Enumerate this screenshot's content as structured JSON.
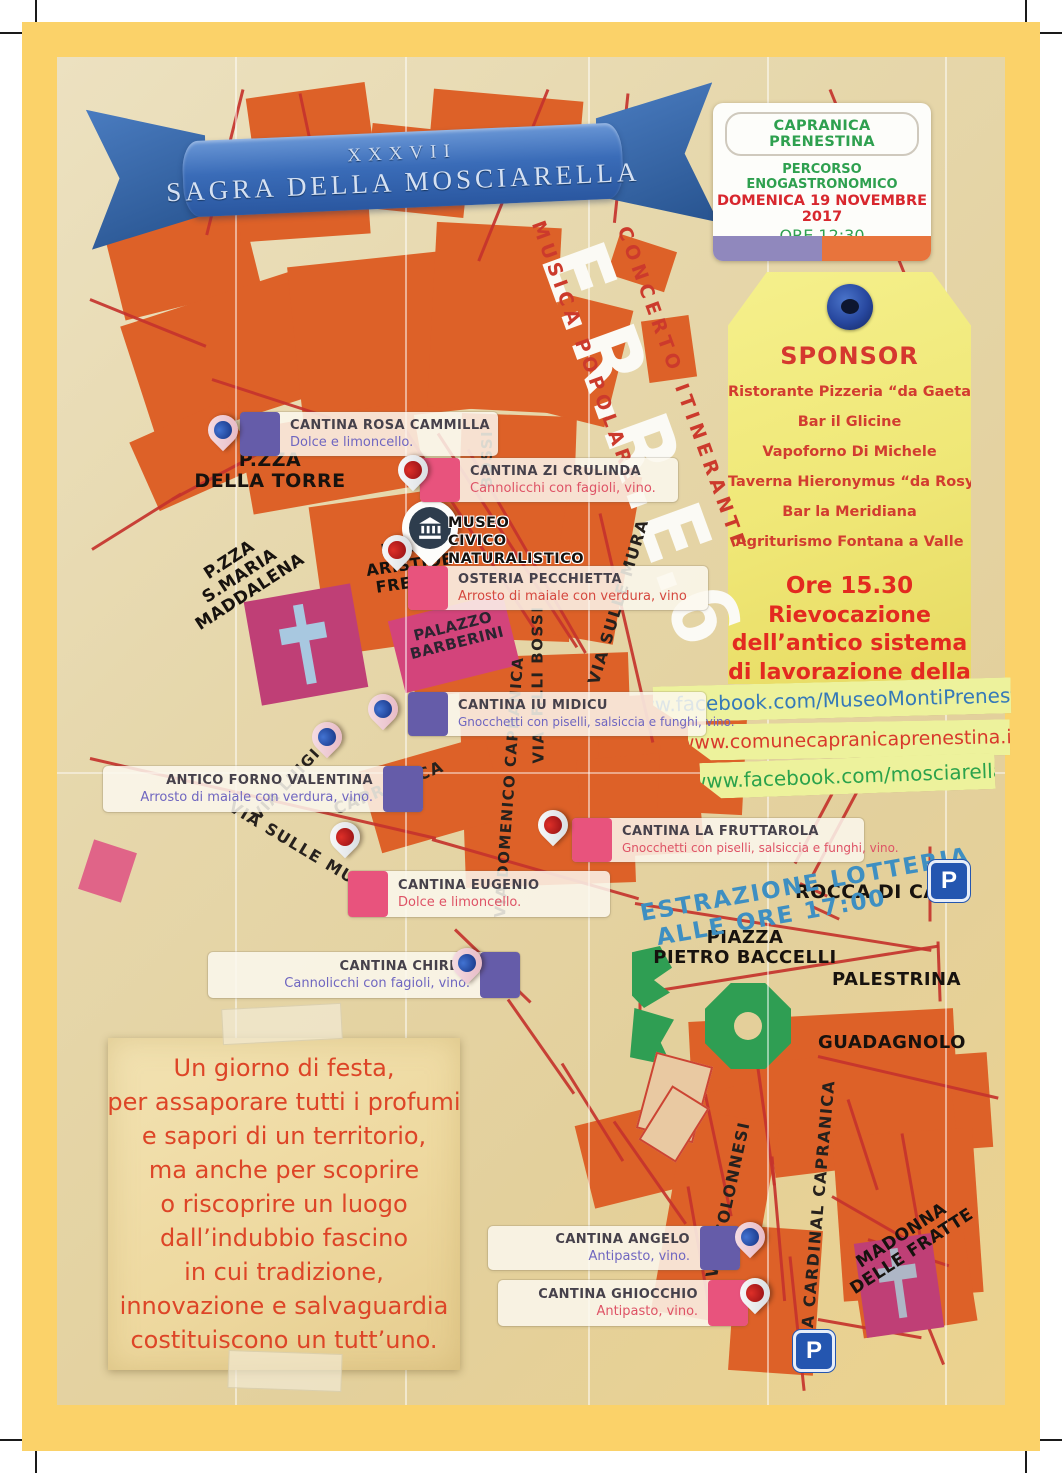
{
  "banner": {
    "edition": "XXXVII",
    "title": "SAGRA DELLA MOSCIARELLA"
  },
  "event_info": {
    "town": "CAPRANICA PRENESTINA",
    "line1": "PERCORSO ENOGASTRONOMICO",
    "line2": "DOMENICA 19 NOVEMBRE 2017",
    "line3": "ORE 12:30",
    "ticket_prefix": "Ticket Percorsi ",
    "ticket_blu": "BLU",
    "ticket_sep": " - ",
    "ticket_rosso": "ROSSO",
    "price": "€ 15,00"
  },
  "sponsor": {
    "title": "SPONSOR",
    "items": [
      "Ristorante Pizzeria “da Gaetano”",
      "Bar il Glicine",
      "Vapoforno Di Michele",
      "Taverna Hieronymus “da Rosy”",
      "Bar la Meridiana",
      "Agriturismo Fontana a Valle"
    ],
    "event_lines": [
      "Ore 15.30",
      "Rievocazione",
      "dell’antico sistema",
      "di lavorazione della",
      "MOSCIARELLA"
    ]
  },
  "links": [
    {
      "text": "www.facebook.com/MuseoMontiPrenestini",
      "color": "#3579b8"
    },
    {
      "text": "www.comunecapranicaprenestina.it",
      "color": "#d8392b"
    },
    {
      "text": "www.facebook.com/mosciarella",
      "color": "#2ba24b"
    }
  ],
  "concert": {
    "name": "E.R.R.E.6",
    "line1": "CONCERTO ITINERANTE",
    "line2": "MUSICA POPOLARE"
  },
  "museum": {
    "lines": [
      "MUSEO",
      "CIVICO",
      "NATURALISTICO"
    ]
  },
  "lottery": {
    "line1": "ESTRAZIONE LOTTERIA",
    "line2": "ALLE ORE 17:00"
  },
  "stops": [
    {
      "name": "CANTINA ROSA CAMMILLA",
      "dish": "Dolce e limoncello.",
      "route": "blu"
    },
    {
      "name": "CANTINA ZI CRULINDA",
      "dish": "Cannolicchi con fagioli, vino.",
      "route": "rosso"
    },
    {
      "name": "OSTERIA PECCHIETTA",
      "dish": "Arrosto di maiale con verdura, vino",
      "route": "rosso"
    },
    {
      "name": "CANTINA IU MIDICU",
      "dish": "Gnocchetti con piselli, salsiccia e funghi, vino.",
      "route": "blu"
    },
    {
      "name": "ANTICO FORNO VALENTINA",
      "dish": "Arrosto di maiale con verdura, vino.",
      "route": "blu"
    },
    {
      "name": "CANTINA LA FRUTTAROLA",
      "dish": "Gnocchetti con piselli, salsiccia e funghi, vino.",
      "route": "rosso"
    },
    {
      "name": "CANTINA EUGENIO",
      "dish": "Dolce e limoncello.",
      "route": "rosso"
    },
    {
      "name": "CANTINA CHIRBA",
      "dish": "Cannolicchi con fagioli, vino.",
      "route": "blu"
    },
    {
      "name": "CANTINA ANGELO",
      "dish": "Antipasto, vino.",
      "route": "blu"
    },
    {
      "name": "CANTINA GHIOCCHIO",
      "dish": "Antipasto, vino.",
      "route": "rosso"
    }
  ],
  "places": [
    {
      "lines": [
        "P.ZZA",
        "DELLA TORRE"
      ]
    },
    {
      "lines": [
        "P.ZZA",
        "S.MARIA",
        "MADDALENA"
      ]
    },
    {
      "lines": [
        "P.ZZA",
        "ARISTIDE",
        "FREZZA"
      ]
    },
    {
      "lines": [
        "PALAZZO",
        "BARBERINI"
      ]
    },
    {
      "lines": [
        "ROCCA DI CAVE"
      ]
    },
    {
      "lines": [
        "PIAZZA",
        "PIETRO BACCELLI"
      ]
    },
    {
      "lines": [
        "PALESTRINA"
      ]
    },
    {
      "lines": [
        "GUADAGNOLO"
      ]
    },
    {
      "lines": [
        "MADONNA",
        "DELLE FRATTE"
      ]
    }
  ],
  "streets": [
    {
      "text": "BOSSI"
    },
    {
      "text": "VIA SULLE MURA"
    },
    {
      "text": "F.LLI BOSSI"
    },
    {
      "text": "VIA"
    },
    {
      "text": "VIA DOMENICO CAPRANICA"
    },
    {
      "text": "CAPRANICA"
    },
    {
      "text": "VIA LUIGI"
    },
    {
      "text": "VIA SULLE MURA"
    },
    {
      "text": "VIA COLONNESI"
    },
    {
      "text": "VIA CARDINAL CAPRANICA"
    }
  ],
  "note": {
    "lines": [
      "Un giorno di festa,",
      "per assaporare tutti i profumi",
      "e sapori di un territorio,",
      "ma anche per scoprire",
      "o riscoprire un luogo",
      "dall’indubbio fascino",
      "in cui tradizione,",
      "innovazione e salvaguardia",
      "costituiscono un tutt’uno."
    ]
  },
  "parking": {
    "label": "P"
  },
  "colors": {
    "route_blu": "#655ca9",
    "route_rosso": "#e8537d",
    "building_orange": "#dd6128",
    "road_red": "#c4332c",
    "frame_yellow": "#fbd269",
    "ribbon_blue": "#3a6cb8",
    "tag_yellow": "#efe776"
  }
}
